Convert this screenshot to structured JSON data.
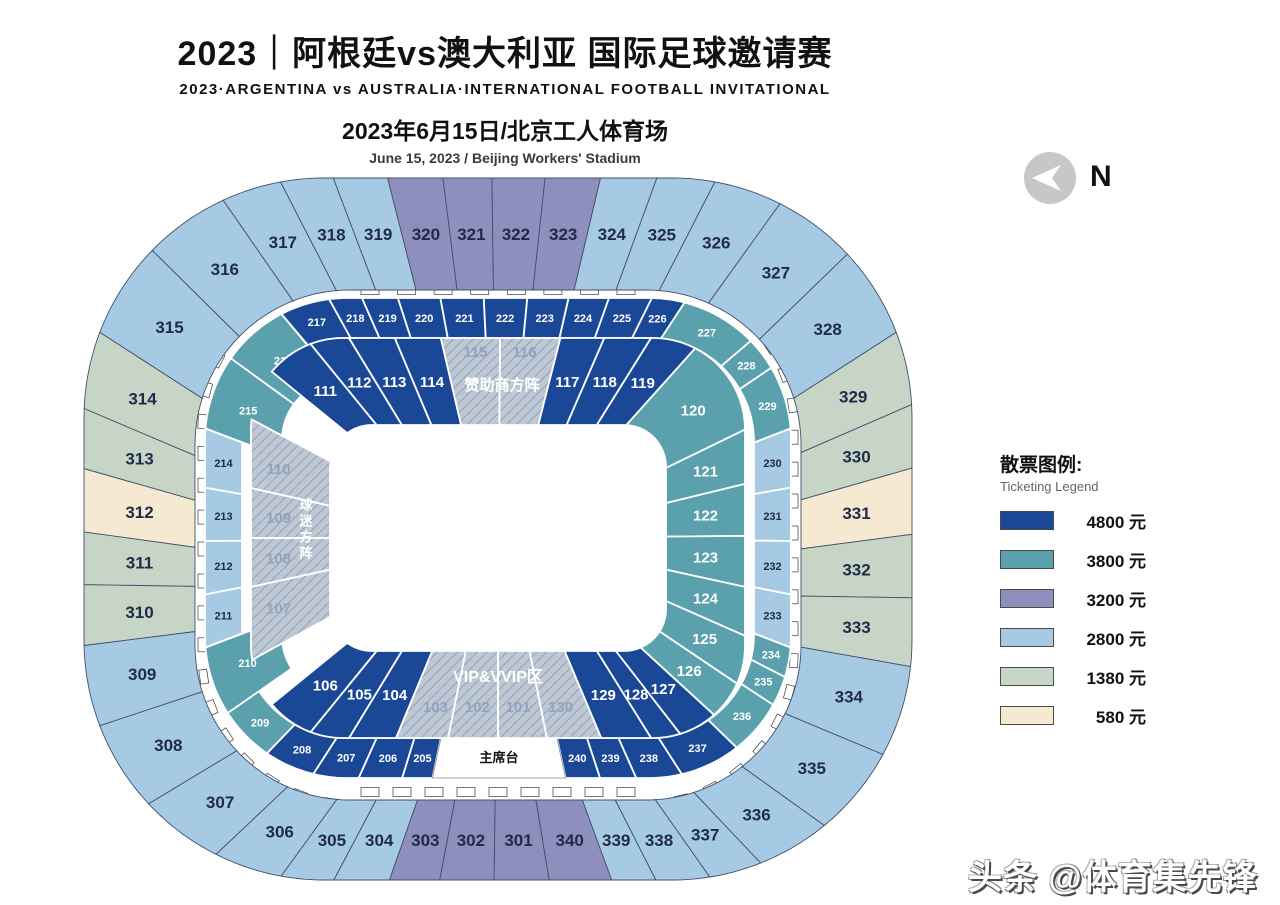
{
  "title": {
    "l1": "2023｜阿根廷vs澳大利亚 国际足球邀请赛",
    "l2": "2023·ARGENTINA vs AUSTRALIA·INTERNATIONAL FOOTBALL INVITATIONAL",
    "l3": "2023年6月15日/北京工人体育场",
    "l4": "June 15, 2023 / Beijing Workers' Stadium"
  },
  "north": {
    "label": "N"
  },
  "watermark": "头条 @体育集先锋",
  "legend": {
    "title": "散票图例:",
    "subtitle": "Ticketing Legend",
    "items": [
      {
        "key": "p4800",
        "price": "4800 元",
        "color": "#1b4896"
      },
      {
        "key": "p3800",
        "price": "3800 元",
        "color": "#5ba0ad"
      },
      {
        "key": "p3200",
        "price": "3200 元",
        "color": "#8f8fbd"
      },
      {
        "key": "p2800",
        "price": "2800 元",
        "color": "#a6c9e4"
      },
      {
        "key": "p1380",
        "price": "1380 元",
        "color": "#c7d5c7"
      },
      {
        "key": "p580",
        "price": "580 元",
        "color": "#f6e9d2"
      }
    ]
  },
  "map": {
    "center_x": 498,
    "colors": {
      "p4800": "#1b4896",
      "p3800": "#5ba0ad",
      "p3200": "#8f8fbd",
      "p2800": "#a6c9e4",
      "p1380": "#c7d5c7",
      "p580": "#f6e9d2",
      "hatch_bg": "#bec8d5",
      "hatch_line": "#93a0b4",
      "dark_text": "#1f2b47",
      "hatch_text": "#93a2bd",
      "border_outer": "#42506b"
    },
    "rings": {
      "r300": {
        "out": {
          "a": 414,
          "b": 351,
          "r": 240,
          "cy": 529
        },
        "in": {
          "a": 303,
          "b": 255,
          "r": 155,
          "cy": 545
        }
      },
      "r200": {
        "out": {
          "a": 293,
          "b": 240,
          "r": 142,
          "cy": 538
        },
        "in": {
          "a": 256,
          "b": 200,
          "r": 104,
          "cy": 538
        }
      },
      "r100": {
        "out": {
          "a": 247,
          "b": 200,
          "r": 92,
          "cy": 538
        },
        "in": {
          "a": 168,
          "b": 113,
          "r": 42,
          "cy": 538
        }
      },
      "deep_in": {
        "a": 216,
        "b": 158,
        "r": 60,
        "cy": 538
      },
      "ticks": {
        "a": 296,
        "b": 263,
        "r": 150,
        "cy": 541
      },
      "ticks2": {
        "a": 282,
        "b": 251,
        "r": 145,
        "cy": 541
      }
    },
    "sections": [
      {
        "id": "316",
        "ring": "r300",
        "cat": "p2800",
        "t0": 0.862,
        "t1": 0.895
      },
      {
        "id": "317",
        "ring": "r300",
        "cat": "p2800",
        "t0": 0.895,
        "t1": 0.9178
      },
      {
        "id": "318",
        "ring": "r300",
        "cat": "p2800",
        "t0": 0.9178,
        "t1": 0.9378
      },
      {
        "id": "319",
        "ring": "r300",
        "cat": "p2800",
        "t0": 0.9378,
        "t1": 0.9583
      },
      {
        "id": "320",
        "ring": "r300",
        "cat": "p3200",
        "t0": 0.9583,
        "t1": 0.9792
      },
      {
        "id": "321",
        "ring": "r300",
        "cat": "p3200",
        "t0": 0.9792,
        "t1": 0.9977
      },
      {
        "id": "322",
        "ring": "r300",
        "cat": "p3200",
        "t0": 0.9977,
        "t1": 1.0178
      },
      {
        "id": "323",
        "ring": "r300",
        "cat": "p3200",
        "t0": 0.0178,
        "t1": 0.0387
      },
      {
        "id": "324",
        "ring": "r300",
        "cat": "p2800",
        "t0": 0.0387,
        "t1": 0.06
      },
      {
        "id": "325",
        "ring": "r300",
        "cat": "p2800",
        "t0": 0.06,
        "t1": 0.082
      },
      {
        "id": "326",
        "ring": "r300",
        "cat": "p2800",
        "t0": 0.082,
        "t1": 0.108
      },
      {
        "id": "327",
        "ring": "r300",
        "cat": "p2800",
        "t0": 0.108,
        "t1": 0.14
      },
      {
        "id": "328",
        "ring": "r300",
        "cat": "p2800",
        "t0": 0.14,
        "t1": 0.175
      },
      {
        "id": "329",
        "ring": "r300",
        "cat": "p1380",
        "t0": 0.175,
        "t1": 0.203
      },
      {
        "id": "330",
        "ring": "r300",
        "cat": "p1380",
        "t0": 0.203,
        "t1": 0.227
      },
      {
        "id": "331",
        "ring": "r300",
        "cat": "p580",
        "t0": 0.227,
        "t1": 0.252
      },
      {
        "id": "332",
        "ring": "r300",
        "cat": "p1380",
        "t0": 0.252,
        "t1": 0.276
      },
      {
        "id": "333",
        "ring": "r300",
        "cat": "p1380",
        "t0": 0.276,
        "t1": 0.302
      },
      {
        "id": "334",
        "ring": "r300",
        "cat": "p2800",
        "t0": 0.302,
        "t1": 0.337
      },
      {
        "id": "335",
        "ring": "r300",
        "cat": "p2800",
        "t0": 0.337,
        "t1": 0.372
      },
      {
        "id": "336",
        "ring": "r300",
        "cat": "p2800",
        "t0": 0.372,
        "t1": 0.4
      },
      {
        "id": "337",
        "ring": "r300",
        "cat": "p2800",
        "t0": 0.4,
        "t1": 0.42
      },
      {
        "id": "338",
        "ring": "r300",
        "cat": "p2800",
        "t0": 0.42,
        "t1": 0.4404
      },
      {
        "id": "339",
        "ring": "r300",
        "cat": "p2800",
        "t0": 0.4404,
        "t1": 0.4571
      },
      {
        "id": "340",
        "ring": "r300",
        "cat": "p3200",
        "t0": 0.4571,
        "t1": 0.4807
      },
      {
        "id": "301",
        "ring": "r300",
        "cat": "p3200",
        "t0": 0.4807,
        "t1": 0.5015
      },
      {
        "id": "302",
        "ring": "r300",
        "cat": "p3200",
        "t0": 0.5015,
        "t1": 0.522
      },
      {
        "id": "303",
        "ring": "r300",
        "cat": "p3200",
        "t0": 0.522,
        "t1": 0.541
      },
      {
        "id": "304",
        "ring": "r300",
        "cat": "p2800",
        "t0": 0.541,
        "t1": 0.562
      },
      {
        "id": "305",
        "ring": "r300",
        "cat": "p2800",
        "t0": 0.562,
        "t1": 0.582
      },
      {
        "id": "306",
        "ring": "r300",
        "cat": "p2800",
        "t0": 0.582,
        "t1": 0.608
      },
      {
        "id": "307",
        "ring": "r300",
        "cat": "p2800",
        "t0": 0.608,
        "t1": 0.64
      },
      {
        "id": "308",
        "ring": "r300",
        "cat": "p2800",
        "t0": 0.64,
        "t1": 0.675
      },
      {
        "id": "309",
        "ring": "r300",
        "cat": "p2800",
        "t0": 0.675,
        "t1": 0.706
      },
      {
        "id": "310",
        "ring": "r300",
        "cat": "p1380",
        "t0": 0.706,
        "t1": 0.729
      },
      {
        "id": "311",
        "ring": "r300",
        "cat": "p1380",
        "t0": 0.729,
        "t1": 0.7489
      },
      {
        "id": "312",
        "ring": "r300",
        "cat": "p580",
        "t0": 0.7489,
        "t1": 0.7728
      },
      {
        "id": "313",
        "ring": "r300",
        "cat": "p1380",
        "t0": 0.7728,
        "t1": 0.7955
      },
      {
        "id": "314",
        "ring": "r300",
        "cat": "p1380",
        "t0": 0.7955,
        "t1": 0.825
      },
      {
        "id": "315",
        "ring": "r300",
        "cat": "p2800",
        "t0": 0.825,
        "t1": 0.862
      },
      {
        "id": "205",
        "ring": "r200",
        "cat": "p4800",
        "t0": 0.5347,
        "t1": 0.5508
      },
      {
        "id": "206",
        "ring": "r200",
        "cat": "p4800",
        "t0": 0.5508,
        "t1": 0.5738
      },
      {
        "id": "207",
        "ring": "r200",
        "cat": "p4800",
        "t0": 0.5738,
        "t1": 0.598
      },
      {
        "id": "208",
        "ring": "r200",
        "cat": "p4800",
        "t0": 0.598,
        "t1": 0.625
      },
      {
        "id": "209",
        "ring": "r200",
        "cat": "p3800",
        "t0": 0.625,
        "t1": 0.655
      },
      {
        "id": "210",
        "ring": "r200",
        "cat": "p3800",
        "t0": 0.655,
        "t1": 0.692,
        "deep": 1
      },
      {
        "id": "211",
        "ring": "r200",
        "cat": "p2800",
        "t0": 0.692,
        "t1": 0.7201
      },
      {
        "id": "212",
        "ring": "r200",
        "cat": "p2800",
        "t0": 0.7201,
        "t1": 0.7484
      },
      {
        "id": "213",
        "ring": "r200",
        "cat": "p2800",
        "t0": 0.7484,
        "t1": 0.7767
      },
      {
        "id": "214",
        "ring": "r200",
        "cat": "p2800",
        "t0": 0.7767,
        "t1": 0.808
      },
      {
        "id": "215",
        "ring": "r200",
        "cat": "p3800",
        "t0": 0.808,
        "t1": 0.848,
        "deep": 1
      },
      {
        "id": "216",
        "ring": "r200",
        "cat": "p3800",
        "t0": 0.848,
        "t1": 0.884,
        "deep": 1
      },
      {
        "id": "217",
        "ring": "r200",
        "cat": "p4800",
        "t0": 0.884,
        "t1": 0.9105
      },
      {
        "id": "218",
        "ring": "r200",
        "cat": "p4800",
        "t0": 0.9105,
        "t1": 0.928
      },
      {
        "id": "219",
        "ring": "r200",
        "cat": "p4800",
        "t0": 0.928,
        "t1": 0.947
      },
      {
        "id": "220",
        "ring": "r200",
        "cat": "p4800",
        "t0": 0.947,
        "t1": 0.9695
      },
      {
        "id": "221",
        "ring": "r200",
        "cat": "p4800",
        "t0": 0.9695,
        "t1": 0.9925
      },
      {
        "id": "222",
        "ring": "r200",
        "cat": "p4800",
        "t0": 0.9925,
        "t1": 1.0155
      },
      {
        "id": "223",
        "ring": "r200",
        "cat": "p4800",
        "t0": 0.0155,
        "t1": 0.0374
      },
      {
        "id": "224",
        "ring": "r200",
        "cat": "p4800",
        "t0": 0.0374,
        "t1": 0.0588
      },
      {
        "id": "225",
        "ring": "r200",
        "cat": "p4800",
        "t0": 0.0588,
        "t1": 0.0815
      },
      {
        "id": "226",
        "ring": "r200",
        "cat": "p4800",
        "t0": 0.0815,
        "t1": 0.099
      },
      {
        "id": "227",
        "ring": "r200",
        "cat": "p3800",
        "t0": 0.099,
        "t1": 0.14
      },
      {
        "id": "228",
        "ring": "r200",
        "cat": "p3800",
        "t0": 0.14,
        "t1": 0.158
      },
      {
        "id": "229",
        "ring": "r200",
        "cat": "p3800",
        "t0": 0.158,
        "t1": 0.192
      },
      {
        "id": "230",
        "ring": "r200",
        "cat": "p2800",
        "t0": 0.192,
        "t1": 0.2233
      },
      {
        "id": "231",
        "ring": "r200",
        "cat": "p2800",
        "t0": 0.2233,
        "t1": 0.2516
      },
      {
        "id": "232",
        "ring": "r200",
        "cat": "p2800",
        "t0": 0.2516,
        "t1": 0.2799
      },
      {
        "id": "233",
        "ring": "r200",
        "cat": "p2800",
        "t0": 0.2799,
        "t1": 0.308
      },
      {
        "id": "234",
        "ring": "r200",
        "cat": "p3800",
        "t0": 0.308,
        "t1": 0.324
      },
      {
        "id": "235",
        "ring": "r200",
        "cat": "p3800",
        "t0": 0.324,
        "t1": 0.34
      },
      {
        "id": "236",
        "ring": "r200",
        "cat": "p3800",
        "t0": 0.34,
        "t1": 0.37
      },
      {
        "id": "237",
        "ring": "r200",
        "cat": "p4800",
        "t0": 0.37,
        "t1": 0.4025
      },
      {
        "id": "238",
        "ring": "r200",
        "cat": "p4800",
        "t0": 0.4025,
        "t1": 0.4268
      },
      {
        "id": "239",
        "ring": "r200",
        "cat": "p4800",
        "t0": 0.4268,
        "t1": 0.446
      },
      {
        "id": "240",
        "ring": "r200",
        "cat": "p4800",
        "t0": 0.446,
        "t1": 0.4642
      },
      {
        "id": "主席台",
        "ring": "r200",
        "cat": "white",
        "t0": 0.4642,
        "t1": 0.5347
      },
      {
        "id": "101",
        "ring": "r100",
        "cat": "hatch",
        "t0": 0.47,
        "t1": 0.5,
        "dy": 12
      },
      {
        "id": "102",
        "ring": "r100",
        "cat": "hatch",
        "t0": 0.5,
        "t1": 0.5307,
        "dy": 12
      },
      {
        "id": "103",
        "ring": "r100",
        "cat": "hatch",
        "t0": 0.5307,
        "t1": 0.5626,
        "dy": 12
      },
      {
        "id": "104",
        "ring": "r100",
        "cat": "p4800",
        "t0": 0.5626,
        "t1": 0.5914
      },
      {
        "id": "105",
        "ring": "r100",
        "cat": "p4800",
        "t0": 0.5914,
        "t1": 0.6154
      },
      {
        "id": "106",
        "ring": "r100",
        "cat": "p4800",
        "t0": 0.6154,
        "t1": 0.645
      },
      {
        "id": "107",
        "ring": "r100",
        "cat": "hatch",
        "t0": 0.6752,
        "t1": 0.72,
        "dx": -12
      },
      {
        "id": "108",
        "ring": "r100",
        "cat": "hatch",
        "t0": 0.72,
        "t1": 0.75,
        "dx": -12
      },
      {
        "id": "109",
        "ring": "r100",
        "cat": "hatch",
        "t0": 0.75,
        "t1": 0.7807,
        "dx": -12
      },
      {
        "id": "110",
        "ring": "r100",
        "cat": "hatch",
        "t0": 0.7807,
        "t1": 0.8228,
        "dx": -12
      },
      {
        "id": "111",
        "ring": "r100",
        "cat": "p4800",
        "t0": 0.855,
        "t1": 0.8846
      },
      {
        "id": "112",
        "ring": "r100",
        "cat": "p4800",
        "t0": 0.8846,
        "t1": 0.9086
      },
      {
        "id": "113",
        "ring": "r100",
        "cat": "p4800",
        "t0": 0.9086,
        "t1": 0.9367
      },
      {
        "id": "114",
        "ring": "r100",
        "cat": "p4800",
        "t0": 0.9367,
        "t1": 0.9649
      },
      {
        "id": "115",
        "ring": "r100",
        "cat": "hatch",
        "t0": 0.9649,
        "t1": 1.0013,
        "dy": -30
      },
      {
        "id": "116",
        "ring": "r100",
        "cat": "hatch",
        "t0": 0.0013,
        "t1": 0.0383,
        "dy": -30
      },
      {
        "id": "117",
        "ring": "r100",
        "cat": "p4800",
        "t0": 0.0383,
        "t1": 0.0652
      },
      {
        "id": "118",
        "ring": "r100",
        "cat": "p4800",
        "t0": 0.0652,
        "t1": 0.0939
      },
      {
        "id": "119",
        "ring": "r100",
        "cat": "p4800",
        "t0": 0.0939,
        "t1": 0.122
      },
      {
        "id": "120",
        "ring": "r100",
        "cat": "p3800",
        "t0": 0.122,
        "t1": 0.1835
      },
      {
        "id": "121",
        "ring": "r100",
        "cat": "p3800",
        "t0": 0.1835,
        "t1": 0.2168
      },
      {
        "id": "122",
        "ring": "r100",
        "cat": "p3800",
        "t0": 0.2168,
        "t1": 0.2487
      },
      {
        "id": "123",
        "ring": "r100",
        "cat": "p3800",
        "t0": 0.2487,
        "t1": 0.28
      },
      {
        "id": "124",
        "ring": "r100",
        "cat": "p3800",
        "t0": 0.28,
        "t1": 0.31
      },
      {
        "id": "125",
        "ring": "r100",
        "cat": "p3800",
        "t0": 0.31,
        "t1": 0.34
      },
      {
        "id": "126",
        "ring": "r100",
        "cat": "p3800",
        "t0": 0.34,
        "t1": 0.364
      },
      {
        "id": "127",
        "ring": "r100",
        "cat": "p4800",
        "t0": 0.364,
        "t1": 0.388
      },
      {
        "id": "128",
        "ring": "r100",
        "cat": "p4800",
        "t0": 0.388,
        "t1": 0.4061
      },
      {
        "id": "129",
        "ring": "r100",
        "cat": "p4800",
        "t0": 0.4061,
        "t1": 0.4367
      },
      {
        "id": "130",
        "ring": "r100",
        "cat": "hatch",
        "t0": 0.4367,
        "t1": 0.47,
        "dy": 12
      }
    ],
    "zone_labels": [
      {
        "id": "sponsor-zone",
        "text": "赞助商方阵",
        "x": 502,
        "y": 390,
        "size": 15,
        "color": "#ffffff",
        "vertical": false
      },
      {
        "id": "vip-zone",
        "text": "VIP&VVIP区",
        "x": 498,
        "y": 682,
        "size": 16,
        "color": "#ffffff",
        "vertical": false
      },
      {
        "id": "fan-zone",
        "text": "球迷方阵",
        "x": 305,
        "y": 530,
        "size": 13,
        "color": "#ffffff",
        "vertical": true
      }
    ],
    "gates": {
      "count": 62,
      "top_extra": 8,
      "bottom_extra": 9
    }
  }
}
